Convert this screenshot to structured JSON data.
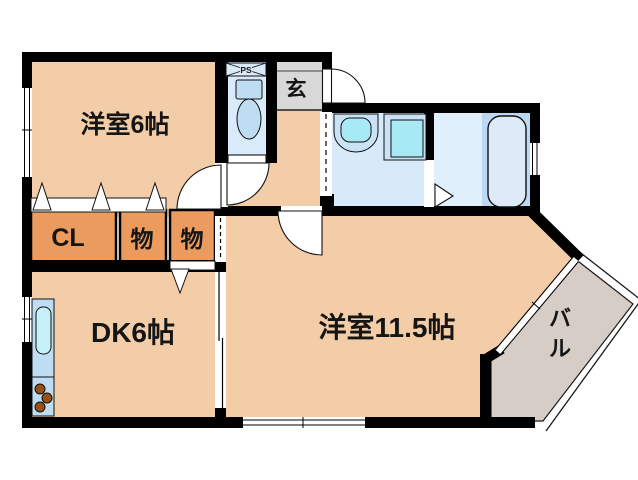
{
  "plan": {
    "rooms": {
      "western6": "洋室6帖",
      "western115": "洋室11.5帖",
      "dk": "DK6帖",
      "closet": "CL",
      "storage_a": "物",
      "storage_b": "物",
      "entrance": "玄",
      "pipe_space": "PS",
      "balcony_char1": "バ",
      "balcony_char2": "ル"
    },
    "colors": {
      "floor_peach": "#F2CDA8",
      "storage_orange": "#EC9B5F",
      "toilet_blue": "#D9EBFA",
      "washroom_blue": "#D7EAF9",
      "bathroom_blue": "#DFEFFC",
      "bath_panel_blue": "#BCD8F2",
      "fixture_blue": "#BFDDF2",
      "fixture_inner_cyan": "#A8EAF4",
      "entrance_gray": "#D8D8D8",
      "balcony_gray": "#D6CEC6",
      "burner_brown": "#9A5014",
      "wall_black": "#000000"
    }
  }
}
